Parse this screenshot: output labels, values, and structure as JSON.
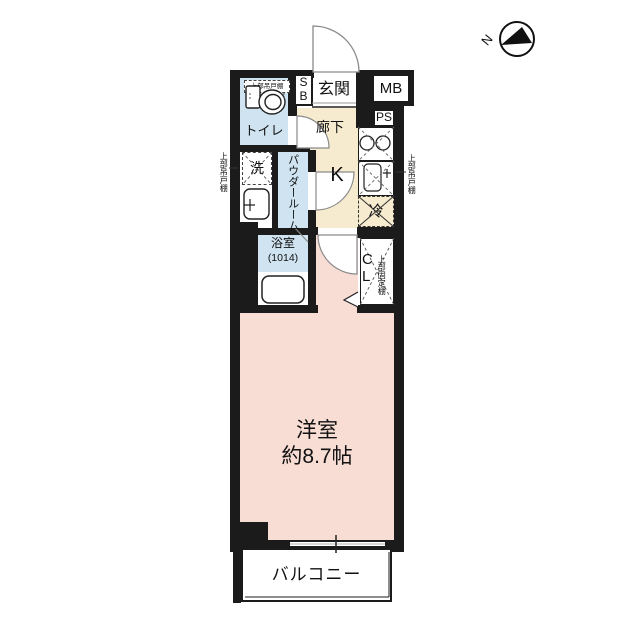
{
  "plan_type": "apartment-floor-plan",
  "compass": {
    "north_label": "N"
  },
  "rooms": {
    "toilet": "トイレ",
    "shoe_box": "SB",
    "entrance": "玄関",
    "meter_box": "MB",
    "pipe_space": "PS",
    "hallway": "廊下",
    "laundry": "洗",
    "powder_room": "パウダールーム",
    "kitchen": "K",
    "refrigerator": "冷",
    "bathroom_name": "浴室",
    "bathroom_size": "(1014)",
    "closet": "CL",
    "western_room_name": "洋室",
    "western_room_size": "約8.7帖",
    "balcony": "バルコニー"
  },
  "annotations": {
    "toilet_upper_shelf": "上部吊戸棚",
    "washer_upper_shelf": "上部吊戸棚",
    "kitchen_upper_shelf": "上部吊戸棚",
    "closet_fixed_shelf": "上部固定棚"
  },
  "colors": {
    "wall": "#1b1b1b",
    "water_rooms": "#cfe3f0",
    "hall_kitchen": "#f7ebcf",
    "main_room": "#f8ddd4"
  }
}
